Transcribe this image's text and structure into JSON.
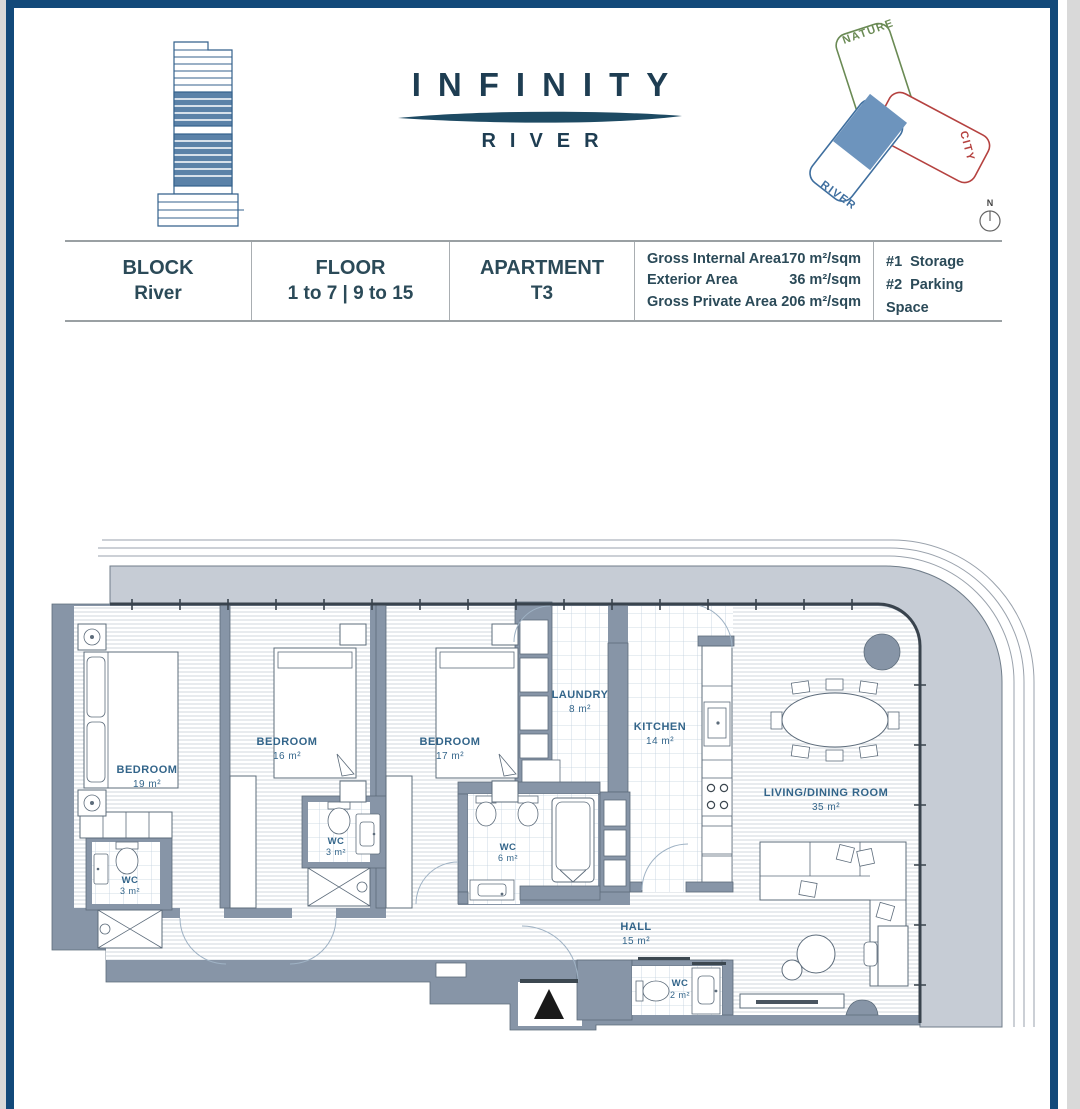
{
  "header": {
    "logo_title": "INFINITY",
    "logo_subtitle": "RIVER"
  },
  "site_diagram": {
    "nature_label": "NATURE",
    "city_label": "CITY",
    "river_label": "RIVER",
    "compass_label": "N"
  },
  "info_table": {
    "block_label": "BLOCK",
    "block_value": "River",
    "floor_label": "FLOOR",
    "floor_value": "1 to 7 | 9 to 15",
    "apartment_label": "APARTMENT",
    "apartment_value": "T3",
    "areas": [
      {
        "label": "Gross Internal Area",
        "value": "170 m²/sqm"
      },
      {
        "label": "Exterior Area",
        "value": "36 m²/sqm"
      },
      {
        "label": "Gross Private Area",
        "value": "206 m²/sqm"
      }
    ],
    "extras": [
      {
        "num": "#1",
        "label": "Storage"
      },
      {
        "num": "#2",
        "label": "Parking Space"
      }
    ]
  },
  "floor_plan": {
    "rooms": [
      {
        "name": "BEDROOM",
        "area": "19 m²"
      },
      {
        "name": "BEDROOM",
        "area": "16 m²"
      },
      {
        "name": "BEDROOM",
        "area": "17 m²"
      },
      {
        "name": "LAUNDRY",
        "area": "8 m²"
      },
      {
        "name": "KITCHEN",
        "area": "14 m²"
      },
      {
        "name": "LIVING/DINING ROOM",
        "area": "35 m²"
      },
      {
        "name": "WC",
        "area": "3 m²"
      },
      {
        "name": "WC",
        "area": "3 m²"
      },
      {
        "name": "WC",
        "area": "6 m²"
      },
      {
        "name": "HALL",
        "area": "15 m²"
      },
      {
        "name": "WC",
        "area": "2 m²"
      }
    ]
  },
  "colors": {
    "frame_navy": "#12497a",
    "wall_gray": "#8795a7",
    "terrace_gray": "#c6ccd5",
    "label_blue": "#33658a",
    "nature_green": "#6a8a54",
    "city_red": "#b54240",
    "river_blue": "#3f6f9f",
    "river_fill": "#6d94bd"
  }
}
